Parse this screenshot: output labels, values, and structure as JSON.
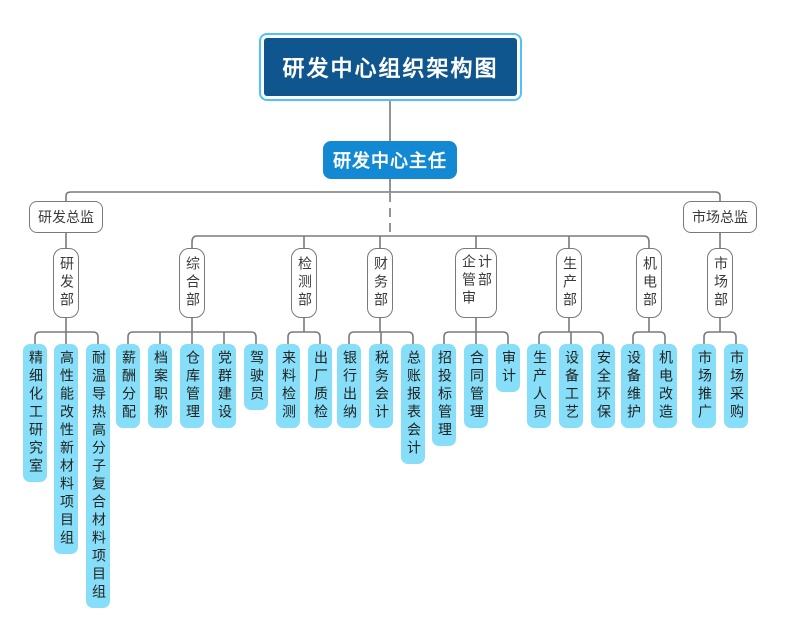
{
  "title": {
    "text": "研发中心组织架构图"
  },
  "director": {
    "text": "研发中心主任"
  },
  "left_branch": {
    "head": "研发总监",
    "dept": "研发部",
    "teams": [
      "精细化工研究室",
      "高性能改性新材料项目组",
      "耐温导热高分子复合材料项目组"
    ]
  },
  "middle_departments": [
    {
      "name": "综合部",
      "teams": [
        "薪酬分配",
        "档案职称",
        "仓库管理",
        "党群建设",
        "驾驶员"
      ]
    },
    {
      "name": "检测部",
      "teams": [
        "来料检测",
        "出厂质检"
      ]
    },
    {
      "name": "财务部",
      "teams": [
        "银行出纳",
        "税务会计",
        "总账报表会计"
      ]
    },
    {
      "name": "企管审计部",
      "teams": [
        "招投标管理",
        "合同管理",
        "审计"
      ]
    },
    {
      "name": "生产部",
      "teams": [
        "生产人员",
        "设备工艺",
        "安全环保"
      ]
    },
    {
      "name": "机电部",
      "teams": [
        "设备维护",
        "机电改造"
      ]
    }
  ],
  "right_branch": {
    "head": "市场总监",
    "dept": "市场部",
    "teams": [
      "市场推广",
      "市场采购"
    ]
  },
  "colors": {
    "title_bg": "#10568e",
    "title_border": "#4fc3f7",
    "director_bg": "#1389d4",
    "leaf_bg": "#87def8",
    "node_border": "#7a7a7a",
    "connector_line": "#7a7a7a",
    "text_dark": "#3a3a3a"
  }
}
